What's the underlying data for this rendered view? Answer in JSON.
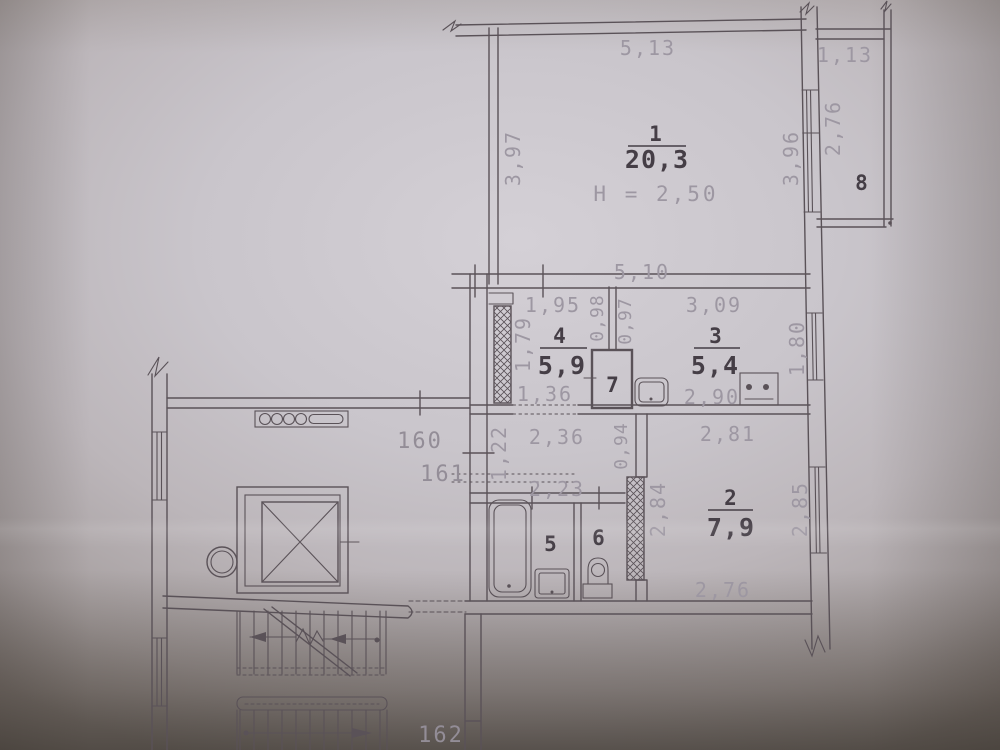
{
  "rooms": {
    "r1": {
      "number": "1",
      "area": "20,3",
      "height_note": "H = 2,50"
    },
    "r2": {
      "number": "2",
      "area": "7,9"
    },
    "r3": {
      "number": "3",
      "area": "5,4"
    },
    "r4": {
      "number": "4",
      "area": "5,9"
    },
    "r5": {
      "number": "5"
    },
    "r6": {
      "number": "6"
    },
    "r7": {
      "number": "7"
    },
    "r8": {
      "number": "8"
    }
  },
  "dimensions": {
    "room1_top": "5,13",
    "balcony_top": "1,13",
    "room1_left": "3,97",
    "room1_right": "3,96",
    "balcony_side": "2,76",
    "room1_bottom": "5,10",
    "room4_top": "1,95",
    "duct_left": "0,98",
    "duct_right": "0,97",
    "room3_top": "3,09",
    "room4_left": "1,79",
    "room3_right": "1,80",
    "room4_door": "1,36",
    "room3_bottom": "2,90",
    "hall_top": "2,36",
    "hall_left": "1,22",
    "hall_duct": "0,94",
    "room2_top": "2,81",
    "hall_bottom": "2,23",
    "room2_left": "2,84",
    "room2_right": "2,85",
    "room2_bottom": "2,76"
  },
  "annotations": {
    "unit_160": "160",
    "unit_161": "161",
    "unit_162": "162"
  },
  "colors": {
    "line": "#5a5258",
    "dim_text": "#9d97a2",
    "room_text": "#453e46",
    "unit_text": "#938d97",
    "paper_center": "#d4d0d6",
    "paper_edge": "#8e8784"
  }
}
